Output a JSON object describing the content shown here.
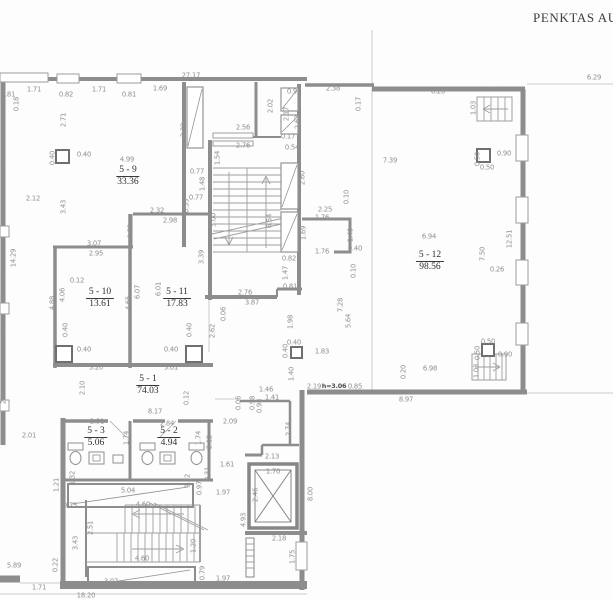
{
  "title": "PENKTAS AUK",
  "colors": {
    "background": "#fdfdfd",
    "wall": "#8d8d8d",
    "thin_line": "#bdbdbd",
    "dimension_text": "#8f8f8f",
    "room_text": "#2e2e2e"
  },
  "rooms": [
    {
      "id": "5 - 9",
      "area": "33.36",
      "x": 128,
      "y": 165
    },
    {
      "id": "5 - 10",
      "area": "13.61",
      "x": 100,
      "y": 287
    },
    {
      "id": "5 - 11",
      "area": "17.83",
      "x": 177,
      "y": 287
    },
    {
      "id": "5 - 12",
      "area": "98.56",
      "x": 430,
      "y": 250
    },
    {
      "id": "5 - 1",
      "area": "74.03",
      "x": 148,
      "y": 374
    },
    {
      "id": "5 - 3",
      "area": "5.06",
      "x": 96,
      "y": 426
    },
    {
      "id": "5 - 2",
      "area": "4.94",
      "x": 169,
      "y": 426
    }
  ],
  "dimensions": [
    {
      "t": "27.17",
      "x": 191,
      "y": 76
    },
    {
      "t": "0.81",
      "x": 8,
      "y": 95
    },
    {
      "t": "1.71",
      "x": 34,
      "y": 90
    },
    {
      "t": "0.82",
      "x": 66,
      "y": 95
    },
    {
      "t": "1.71",
      "x": 99,
      "y": 90
    },
    {
      "t": "0.81",
      "x": 129,
      "y": 95
    },
    {
      "t": "1.69",
      "x": 160,
      "y": 89
    },
    {
      "t": "0.92",
      "x": 294,
      "y": 92
    },
    {
      "t": "2.38",
      "x": 333,
      "y": 89
    },
    {
      "t": "0.17",
      "x": 359,
      "y": 104,
      "v": 1
    },
    {
      "t": "6.20",
      "x": 438,
      "y": 92
    },
    {
      "t": "1.50",
      "x": 493,
      "y": 90
    },
    {
      "t": "6.29",
      "x": 594,
      "y": 78
    },
    {
      "t": "1.03",
      "x": 474,
      "y": 108,
      "v": 1
    },
    {
      "t": "0.18",
      "x": 17,
      "y": 104,
      "v": 1
    },
    {
      "t": "2.71",
      "x": 64,
      "y": 120,
      "v": 1
    },
    {
      "t": "3.22",
      "x": 184,
      "y": 130,
      "v": 1
    },
    {
      "t": "2.02",
      "x": 271,
      "y": 106,
      "v": 1
    },
    {
      "t": "2.17",
      "x": 287,
      "y": 114,
      "v": 1
    },
    {
      "t": "2.63",
      "x": 298,
      "y": 122,
      "v": 1
    },
    {
      "t": "2.56",
      "x": 243,
      "y": 128
    },
    {
      "t": "2.76",
      "x": 243,
      "y": 146
    },
    {
      "t": "0.17",
      "x": 288,
      "y": 137
    },
    {
      "t": "0.54",
      "x": 292,
      "y": 148
    },
    {
      "t": "1.54",
      "x": 218,
      "y": 158,
      "v": 1
    },
    {
      "t": "0.40",
      "x": 84,
      "y": 155
    },
    {
      "t": "0.40",
      "x": 53,
      "y": 158,
      "v": 1
    },
    {
      "t": "4.99",
      "x": 127,
      "y": 160
    },
    {
      "t": "0.77",
      "x": 197,
      "y": 172
    },
    {
      "t": "1.48",
      "x": 203,
      "y": 184,
      "v": 1
    },
    {
      "t": "6.03",
      "x": 4,
      "y": 160,
      "v": 1
    },
    {
      "t": "7.39",
      "x": 390,
      "y": 161
    },
    {
      "t": "0.90",
      "x": 504,
      "y": 154
    },
    {
      "t": "0.50",
      "x": 478,
      "y": 159,
      "v": 1
    },
    {
      "t": "0.50",
      "x": 487,
      "y": 168
    },
    {
      "t": "2.60",
      "x": 303,
      "y": 178,
      "v": 1
    },
    {
      "t": "2.12",
      "x": 33,
      "y": 199
    },
    {
      "t": "3.43",
      "x": 64,
      "y": 207,
      "v": 1
    },
    {
      "t": "0.77",
      "x": 196,
      "y": 198
    },
    {
      "t": "0.53",
      "x": 187,
      "y": 206,
      "v": 1
    },
    {
      "t": "2.32",
      "x": 157,
      "y": 211
    },
    {
      "t": "2.98",
      "x": 170,
      "y": 221
    },
    {
      "t": "1.32",
      "x": 131,
      "y": 231,
      "v": 1
    },
    {
      "t": "3.00",
      "x": 214,
      "y": 220,
      "v": 1
    },
    {
      "t": "6.54",
      "x": 270,
      "y": 221,
      "v": 1
    },
    {
      "t": "0.10",
      "x": 347,
      "y": 197,
      "v": 1
    },
    {
      "t": "2.25",
      "x": 325,
      "y": 210
    },
    {
      "t": "1.76",
      "x": 322,
      "y": 218
    },
    {
      "t": "1.69",
      "x": 304,
      "y": 233,
      "v": 1
    },
    {
      "t": "1.49",
      "x": 351,
      "y": 235,
      "v": 1
    },
    {
      "t": "0.40",
      "x": 355,
      "y": 249
    },
    {
      "t": "1.76",
      "x": 322,
      "y": 252
    },
    {
      "t": "0.10",
      "x": 354,
      "y": 271,
      "v": 1
    },
    {
      "t": "14.29",
      "x": 14,
      "y": 258,
      "v": 1
    },
    {
      "t": "2.64",
      "x": 4,
      "y": 278,
      "v": 1
    },
    {
      "t": "3.07",
      "x": 94,
      "y": 244
    },
    {
      "t": "2.95",
      "x": 96,
      "y": 254
    },
    {
      "t": "3.39",
      "x": 202,
      "y": 257,
      "v": 1
    },
    {
      "t": "2.76",
      "x": 245,
      "y": 293
    },
    {
      "t": "3.87",
      "x": 252,
      "y": 303
    },
    {
      "t": "0.82",
      "x": 289,
      "y": 259
    },
    {
      "t": "1.47",
      "x": 286,
      "y": 273,
      "v": 1
    },
    {
      "t": "0.81",
      "x": 290,
      "y": 287
    },
    {
      "t": "1.98",
      "x": 291,
      "y": 322,
      "v": 1
    },
    {
      "t": "7.28",
      "x": 341,
      "y": 305,
      "v": 1
    },
    {
      "t": "5.64",
      "x": 349,
      "y": 321,
      "v": 1
    },
    {
      "t": "0.12",
      "x": 77,
      "y": 281
    },
    {
      "t": "4.88",
      "x": 53,
      "y": 303,
      "v": 1
    },
    {
      "t": "4.06",
      "x": 63,
      "y": 295,
      "v": 1
    },
    {
      "t": "4.65",
      "x": 129,
      "y": 303,
      "v": 1
    },
    {
      "t": "6.07",
      "x": 138,
      "y": 292,
      "v": 1
    },
    {
      "t": "6.01",
      "x": 159,
      "y": 289,
      "v": 1
    },
    {
      "t": "2.65",
      "x": 4,
      "y": 335,
      "v": 1
    },
    {
      "t": "0.06",
      "x": 224,
      "y": 314,
      "v": 1
    },
    {
      "t": "2.62",
      "x": 213,
      "y": 331,
      "v": 1
    },
    {
      "t": "6.94",
      "x": 429,
      "y": 237
    },
    {
      "t": "7.50",
      "x": 483,
      "y": 254,
      "v": 1
    },
    {
      "t": "12.51",
      "x": 510,
      "y": 239,
      "v": 1
    },
    {
      "t": "13.02",
      "x": 524,
      "y": 237,
      "v": 1
    },
    {
      "t": "0.26",
      "x": 497,
      "y": 270
    },
    {
      "t": "0.40",
      "x": 66,
      "y": 330,
      "v": 1
    },
    {
      "t": "0.40",
      "x": 84,
      "y": 350
    },
    {
      "t": "0.40",
      "x": 171,
      "y": 350
    },
    {
      "t": "0.40",
      "x": 190,
      "y": 330,
      "v": 1
    },
    {
      "t": "1.83",
      "x": 322,
      "y": 352
    },
    {
      "t": "0.40",
      "x": 294,
      "y": 343
    },
    {
      "t": "0.40",
      "x": 286,
      "y": 351,
      "v": 1
    },
    {
      "t": "1.40",
      "x": 292,
      "y": 374,
      "v": 1
    },
    {
      "t": "3.20",
      "x": 96,
      "y": 368
    },
    {
      "t": "3.01",
      "x": 171,
      "y": 368
    },
    {
      "t": "2.65",
      "x": 4,
      "y": 397,
      "v": 1
    },
    {
      "t": "2.10",
      "x": 83,
      "y": 388,
      "v": 1
    },
    {
      "t": "0.50",
      "x": 488,
      "y": 342
    },
    {
      "t": "0.50",
      "x": 478,
      "y": 353,
      "v": 1
    },
    {
      "t": "0.90",
      "x": 505,
      "y": 355
    },
    {
      "t": "1.03",
      "x": 477,
      "y": 371,
      "v": 1
    },
    {
      "t": "6.98",
      "x": 430,
      "y": 369
    },
    {
      "t": "0.20",
      "x": 404,
      "y": 372,
      "v": 1
    },
    {
      "t": "2.19",
      "x": 314,
      "y": 387
    },
    {
      "t": "h=3.06",
      "x": 334,
      "y": 386,
      "b": 1
    },
    {
      "t": "0.85",
      "x": 355,
      "y": 387
    },
    {
      "t": "1.71",
      "x": 388,
      "y": 393
    },
    {
      "t": "8.97",
      "x": 406,
      "y": 400
    },
    {
      "t": "1.46",
      "x": 266,
      "y": 390
    },
    {
      "t": "1.41",
      "x": 272,
      "y": 398
    },
    {
      "t": "0.98",
      "x": 253,
      "y": 403,
      "v": 1
    },
    {
      "t": "0.98",
      "x": 260,
      "y": 406,
      "v": 1
    },
    {
      "t": "0.06",
      "x": 239,
      "y": 403,
      "v": 1
    },
    {
      "t": "0.12",
      "x": 187,
      "y": 398,
      "v": 1
    },
    {
      "t": "2.09",
      "x": 230,
      "y": 422
    },
    {
      "t": "2.01",
      "x": 29,
      "y": 436
    },
    {
      "t": "8.17",
      "x": 155,
      "y": 412
    },
    {
      "t": "2.91",
      "x": 97,
      "y": 422
    },
    {
      "t": "2.84",
      "x": 167,
      "y": 424
    },
    {
      "t": "1.74",
      "x": 127,
      "y": 438,
      "v": 1
    },
    {
      "t": "1.74",
      "x": 199,
      "y": 438,
      "v": 1
    },
    {
      "t": "2.12",
      "x": 210,
      "y": 442,
      "v": 1
    },
    {
      "t": "2.74",
      "x": 289,
      "y": 429,
      "v": 1
    },
    {
      "t": "1.61",
      "x": 227,
      "y": 465
    },
    {
      "t": "2.13",
      "x": 272,
      "y": 457
    },
    {
      "t": "1.70",
      "x": 273,
      "y": 472
    },
    {
      "t": "1.32",
      "x": 73,
      "y": 478,
      "v": 1
    },
    {
      "t": "1.32",
      "x": 188,
      "y": 481,
      "v": 1
    },
    {
      "t": "1.21",
      "x": 57,
      "y": 485,
      "v": 1
    },
    {
      "t": "0.97",
      "x": 200,
      "y": 488,
      "v": 1
    },
    {
      "t": "0.31",
      "x": 208,
      "y": 474,
      "v": 1
    },
    {
      "t": "5.04",
      "x": 128,
      "y": 491
    },
    {
      "t": "1.97",
      "x": 223,
      "y": 493
    },
    {
      "t": "2.46",
      "x": 256,
      "y": 495,
      "v": 1
    },
    {
      "t": "8.00",
      "x": 311,
      "y": 494,
      "v": 1
    },
    {
      "t": "4.93",
      "x": 244,
      "y": 520,
      "v": 1
    },
    {
      "t": "0.75",
      "x": 70,
      "y": 506
    },
    {
      "t": "4.60",
      "x": 143,
      "y": 505
    },
    {
      "t": "2.51",
      "x": 91,
      "y": 528,
      "v": 1
    },
    {
      "t": "3.43",
      "x": 76,
      "y": 543,
      "v": 1
    },
    {
      "t": "1.20",
      "x": 194,
      "y": 546,
      "v": 1
    },
    {
      "t": "4.60",
      "x": 142,
      "y": 559
    },
    {
      "t": "2.18",
      "x": 279,
      "y": 539
    },
    {
      "t": "1.75",
      "x": 293,
      "y": 557,
      "v": 1
    },
    {
      "t": "0.22",
      "x": 56,
      "y": 565,
      "v": 1
    },
    {
      "t": "5.89",
      "x": 14,
      "y": 566
    },
    {
      "t": "3.07",
      "x": 111,
      "y": 582
    },
    {
      "t": "1.71",
      "x": 39,
      "y": 588
    },
    {
      "t": "18.20",
      "x": 86,
      "y": 596
    },
    {
      "t": "0.79",
      "x": 203,
      "y": 573,
      "v": 1
    },
    {
      "t": "1.97",
      "x": 223,
      "y": 579
    }
  ]
}
